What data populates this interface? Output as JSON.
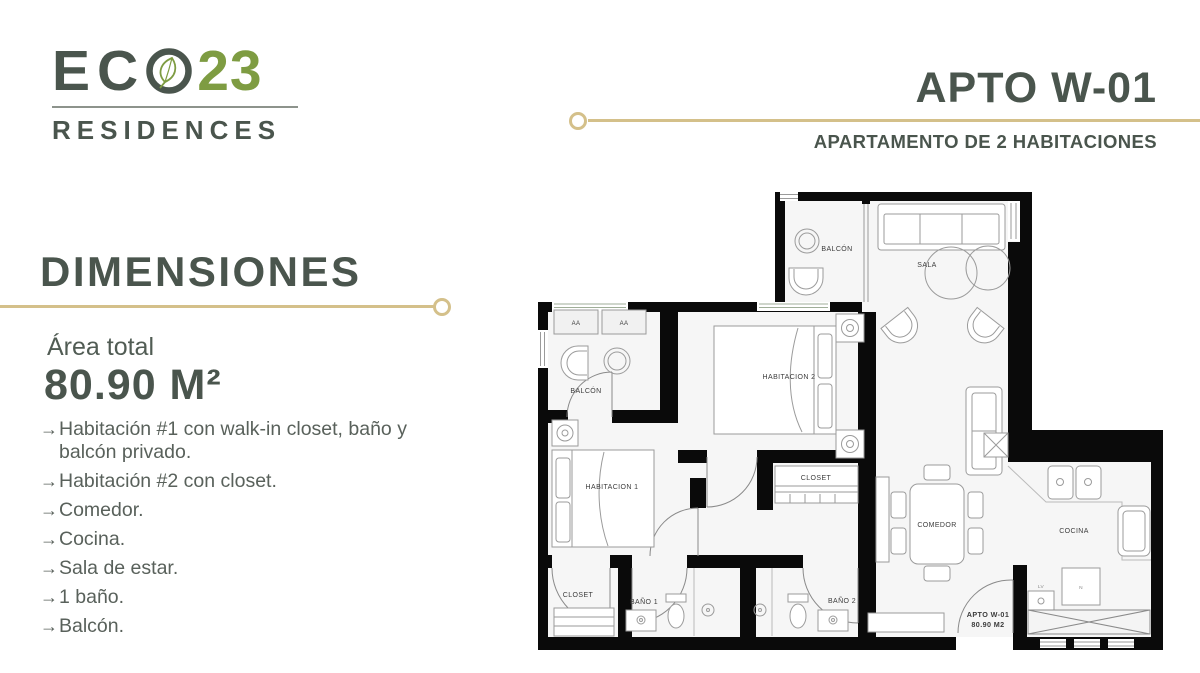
{
  "brand": {
    "name_prefix": "EC",
    "o_icon": "ring-with-leaf",
    "number": "23",
    "sub": "RESIDENCES",
    "colors": {
      "dark": "#4a554d",
      "green": "#7e9c42",
      "gold": "#d4c08a"
    }
  },
  "header": {
    "title": "APTO W-01",
    "subtitle": "APARTAMENTO DE 2 HABITACIONES"
  },
  "dims": {
    "heading": "DIMENSIONES",
    "area_label": "Área total",
    "area_value": "80.90 M²",
    "bullet_icon": "→",
    "features": [
      "Habitación #1 con walk-in closet, baño y balcón privado.",
      "Habitación #2 con closet.",
      "Comedor.",
      "Cocina.",
      "Sala de estar.",
      "1 baño.",
      "Balcón."
    ]
  },
  "floorplan": {
    "balcony_top": "BALCÓN",
    "sala": "SALA",
    "bedroom2": "HABITACION 2",
    "ac_unit": "AA",
    "balcony_left": "BALCÓN",
    "bedroom1": "HABITACION 1",
    "closet_bedroom2": "CLOSET",
    "dining": "COMEDOR",
    "kitchen": "COCINA",
    "closet_hall": "CLOSET",
    "bath1": "BAÑO 1",
    "bath2": "BAÑO 2",
    "washer": "LV",
    "pantry": "N",
    "unit_label": "APTO W-01",
    "unit_area": "80.90 M2"
  }
}
